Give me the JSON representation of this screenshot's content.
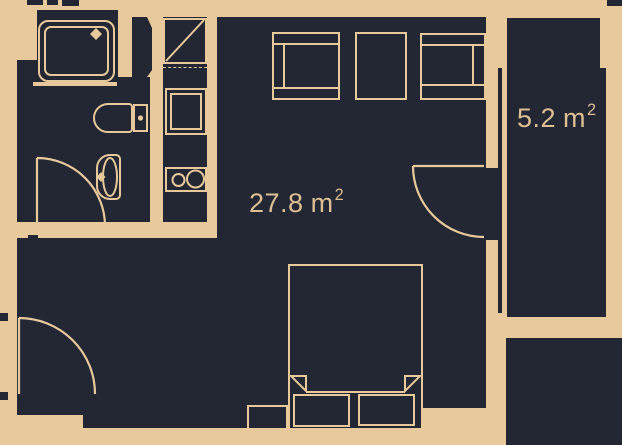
{
  "plan": {
    "type": "apartment-floor-plan",
    "main_room": {
      "area_value": "27.8",
      "area_unit": "m",
      "area_sup": "2"
    },
    "balcony": {
      "area_value": "5.2",
      "area_unit": "m",
      "area_sup": "2"
    }
  },
  "fixtures": [
    "shower",
    "toilet",
    "sink",
    "ventilation-shaft",
    "wardrobe-cabinet",
    "oven",
    "cooktop",
    "sofa",
    "table",
    "desk",
    "bed",
    "pillow",
    "nightstand",
    "entrance-door",
    "bathroom-door",
    "balcony-door",
    "balcony-window"
  ],
  "colors": {
    "wall": "#e8c99c",
    "floor": "#232733",
    "label_text": "#debf94"
  }
}
